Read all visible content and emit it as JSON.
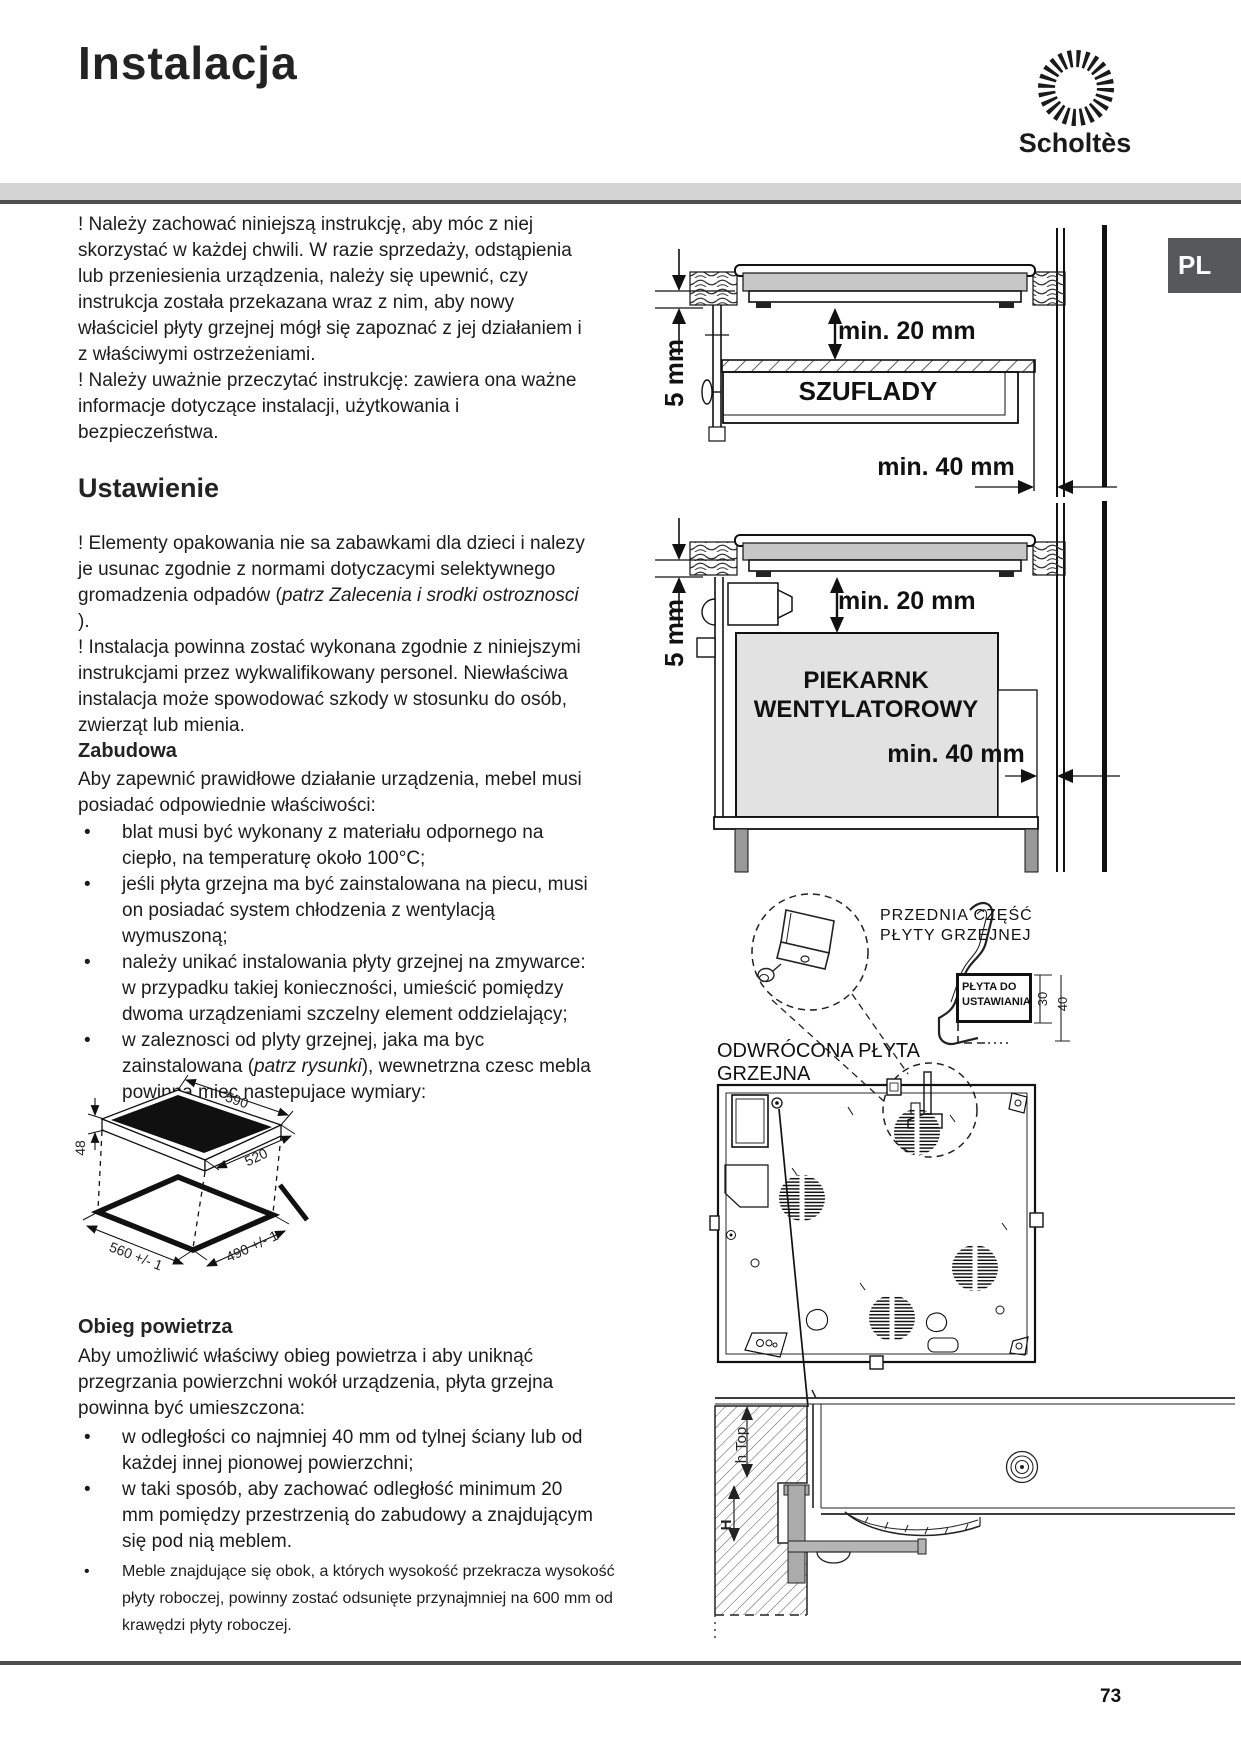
{
  "header": {
    "title": "Instalacja",
    "brand": "Scholtès",
    "lang_badge": "PL"
  },
  "intro": {
    "p1": "! Należy zachować niniejszą instrukcję, aby móc z niej skorzystać w każdej chwili. W razie sprzedaży, odstąpienia lub przeniesienia urządzenia, należy się upewnić, czy instrukcja została przekazana wraz z nim, aby nowy właściciel płyty grzejnej mógł się zapoznać z jej działaniem i z właściwymi ostrzeżeniami.",
    "p2": "! Należy uważnie przeczytać instrukcję: zawiera ona ważne informacje dotyczące instalacji, użytkowania i bezpieczeństwa."
  },
  "ustawienie": {
    "heading": "Ustawienie",
    "p1_pre": "! Elementy opakowania nie sa zabawkami dla dzieci i nalezy je usunac zgodnie z normami dotyczacymi selektywnego gromadzenia odpadów (",
    "p1_italic": "patrz Zalecenia i srodki ostroznosci",
    "p1_post": " ).",
    "p2": "! Instalacja powinna zostać wykonana zgodnie z niniejszymi instrukcjami przez wykwalifikowany personel. Niewłaściwa instalacja może spowodować szkody w stosunku do osób, zwierząt lub mienia."
  },
  "zabudowa": {
    "heading": "Zabudowa",
    "intro": "Aby zapewnić prawidłowe działanie urządzenia, mebel musi posiadać odpowiednie właściwości:",
    "bullet1": "blat musi być wykonany z materiału odpornego na ciepło, na temperaturę około 100°C;",
    "bullet2": "jeśli płyta grzejna ma być zainstalowana na piecu, musi on posiadać system chłodzenia z wentylacją wymuszoną;",
    "bullet3": "należy unikać instalowania płyty grzejnej na zmywarce: w przypadku takiej konieczności, umieścić pomiędzy dwoma urządzeniami szczelny element oddzielający;",
    "bullet4_pre": "w zaleznosci od plyty grzejnej, jaka ma byc zainstalowana (",
    "bullet4_italic": "patrz rysunki",
    "bullet4_post": "), wewnetrzna czesc mebla powinna miec nastepujace wymiary:"
  },
  "hob_diagram": {
    "width": "590",
    "height": "48",
    "depth": "520",
    "cutout_width": "560 +/- 1",
    "cutout_depth": "490 +/- 1"
  },
  "obieg": {
    "heading": "Obieg powietrza",
    "intro": "Aby umożliwić właściwy obieg powietrza i aby uniknąć przegrzania powierzchni wokół urządzenia, płyta grzejna powinna być umieszczona:",
    "bullet1": "w odległości co najmniej 40 mm od tylnej ściany lub od każdej innej pionowej powierzchni;",
    "bullet2": "w taki sposób, aby zachować odległość minimum 20 mm pomiędzy przestrzenią do zabudowy a znajdującym się pod nią meblem.",
    "small_bullet": "Meble znajdujące się obok, a których wysokość przekracza wysokość płyty roboczej, powinny zostać odsunięte przynajmniej na 600 mm od krawędzi płyty roboczej."
  },
  "diagram_drawer": {
    "gap_side": "5 mm",
    "gap_below": "min. 20 mm",
    "label": "SZUFLADY",
    "gap_back": "min. 40 mm"
  },
  "diagram_oven": {
    "gap_side": "5 mm",
    "gap_below": "min. 20 mm",
    "label_line1": "PIEKARNK",
    "label_line2": "WENTYLATOROWY",
    "gap_back": "min. 40 mm"
  },
  "diagram_bracket": {
    "front_line1": "PRZEDNIA CZĘŚĆ",
    "front_line2": "PŁYTY GRZEJNEJ",
    "plate_line1": "PŁYTA DO",
    "plate_line2": "USTAWIANIA",
    "dim_30": "30",
    "dim_40": "40",
    "inverted_line1": "ODWRÓCONA PŁYTA",
    "inverted_line2": "GRZEJNA"
  },
  "diagram_section": {
    "h_top": "h Top",
    "h": "H"
  },
  "footer": {
    "page_number": "73"
  }
}
